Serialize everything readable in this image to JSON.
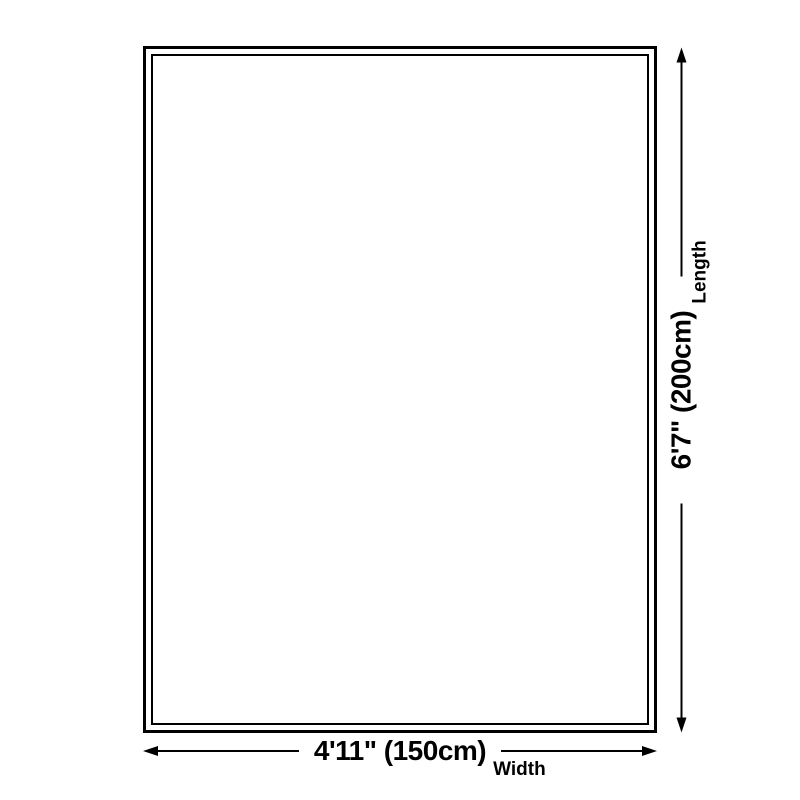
{
  "diagram": {
    "type": "product-size-diagram",
    "dimensions": {
      "length": {
        "value": "6'7\" (200cm)",
        "label": "Length"
      },
      "width": {
        "value": "4'11\" (150cm)",
        "label": "Width"
      }
    }
  },
  "colors": {
    "ink": "#000000",
    "background": "#ffffff"
  }
}
